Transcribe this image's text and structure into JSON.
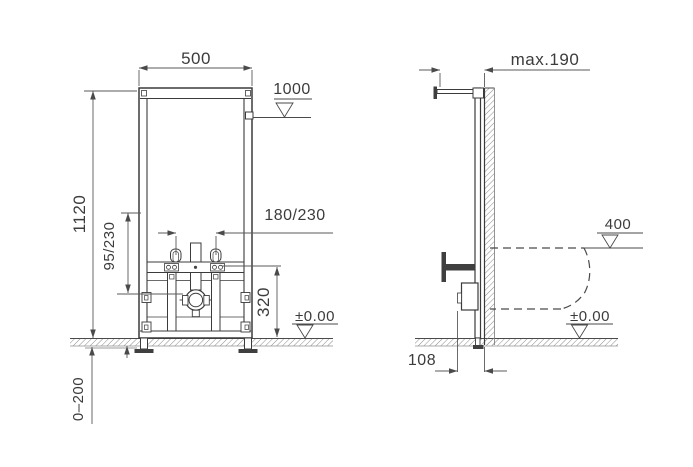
{
  "front_view": {
    "frame_width": "500",
    "frame_height": "1120",
    "top_fixing_level": "1000",
    "fixing_bolt_spacing": "180/230",
    "drain_offset": "95/230",
    "water_connection_height": "320",
    "finished_floor_level": "±0.00",
    "height_adjustment_range": "0–200"
  },
  "side_view": {
    "max_wall_distance": "max.190",
    "bidet_rim_level": "400",
    "finished_floor_level": "±0.00",
    "drain_to_wall_distance": "108"
  }
}
